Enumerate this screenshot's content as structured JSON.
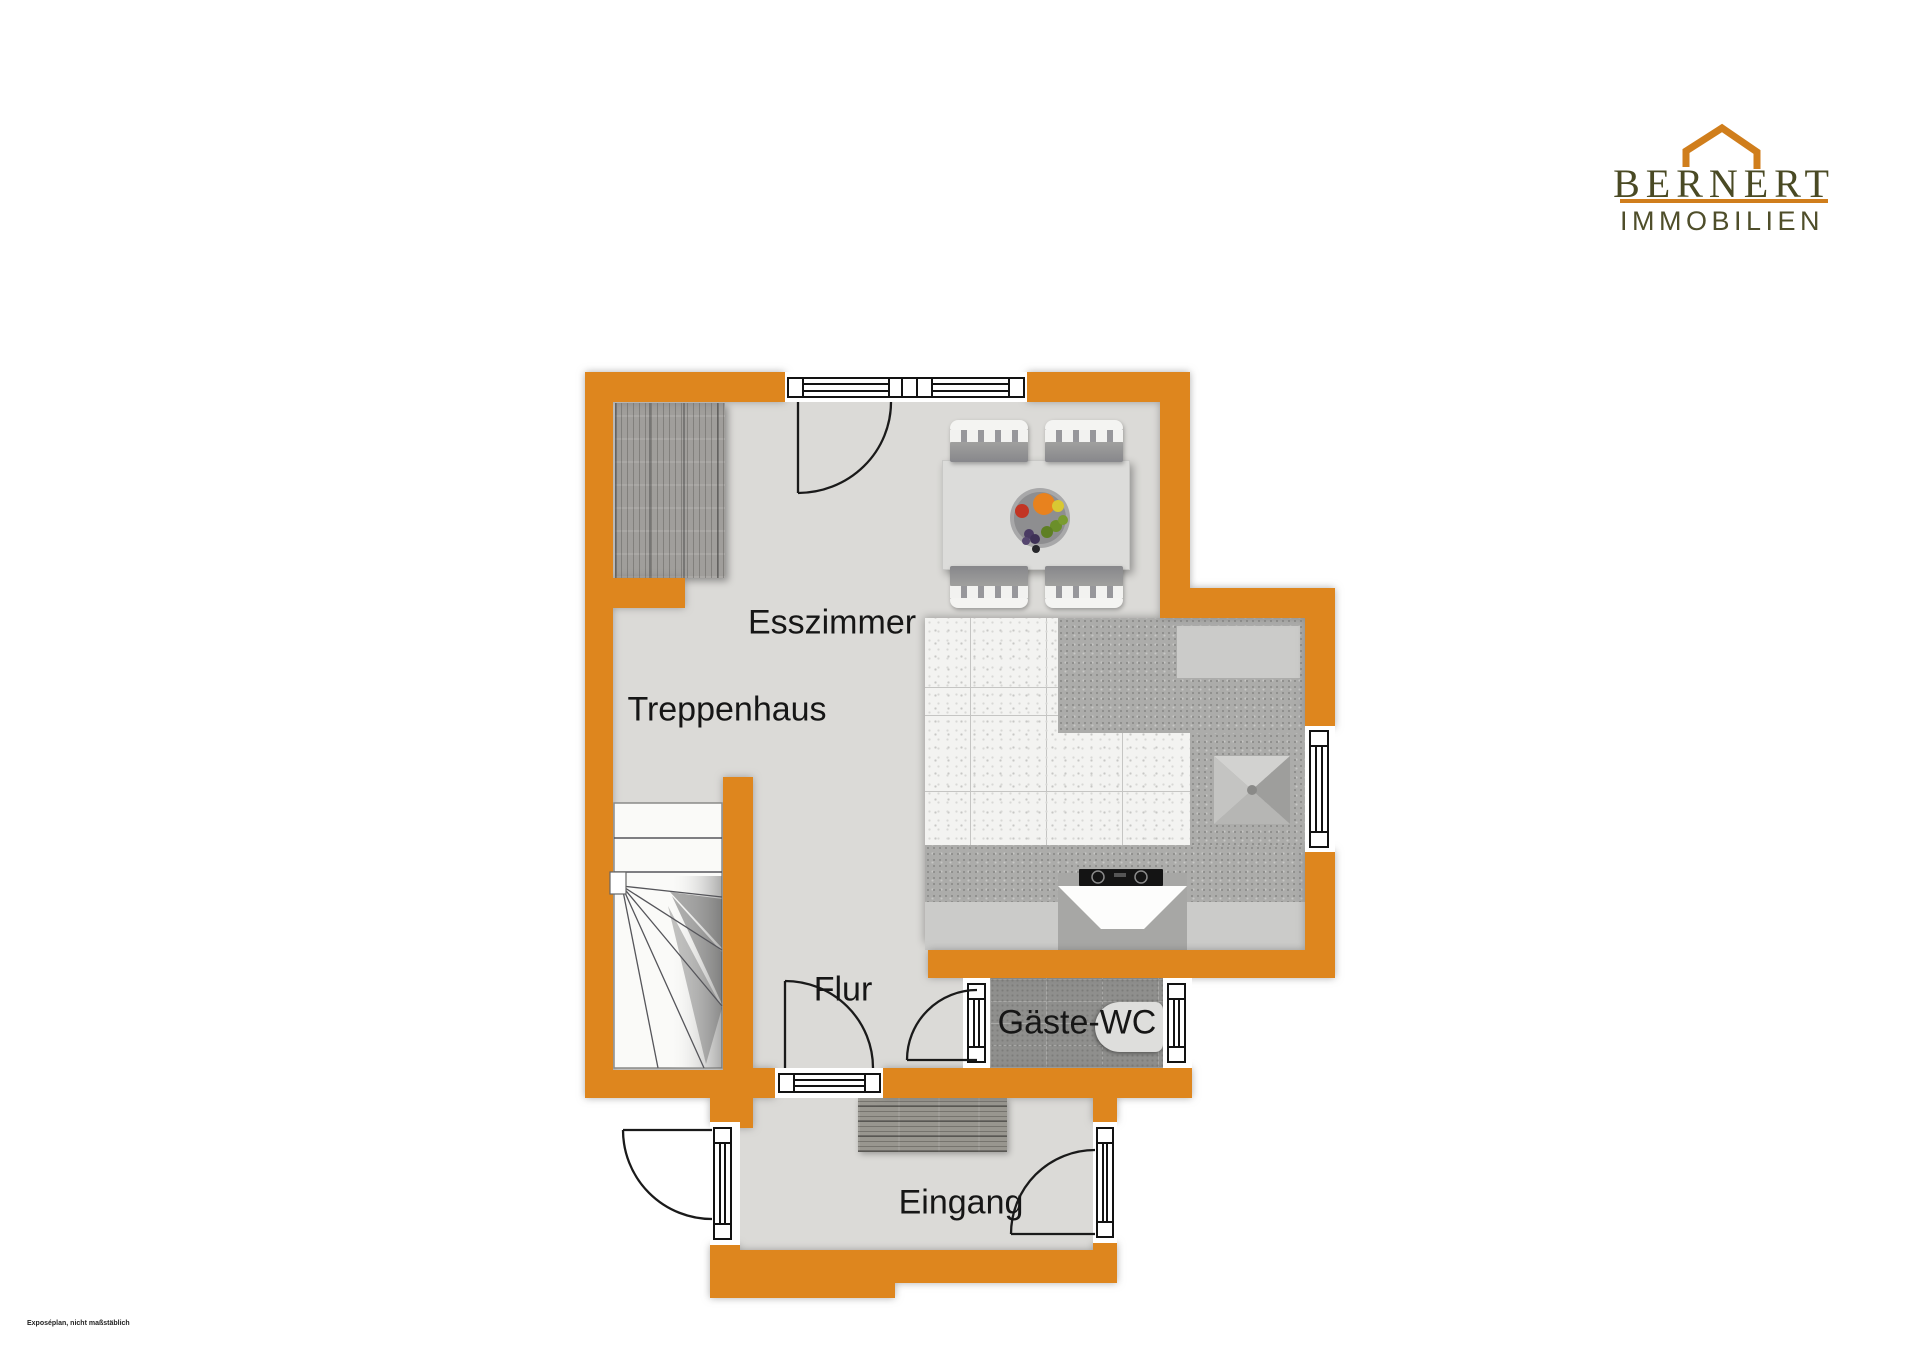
{
  "colors": {
    "wall": "#DE861E",
    "floor": "#DBDAD7",
    "accent": "#D07E1C",
    "brand": "#4A4A24"
  },
  "logo": {
    "roof_icon": "roof-icon",
    "brand": "BERNERT",
    "tagline": "IMMOBILIEN"
  },
  "plan": {
    "rooms": {
      "esszimmer": "Esszimmer",
      "treppenhaus": "Treppenhaus",
      "flur": "Flur",
      "gaeste_wc": "Gäste-WC",
      "eingang": "Eingang"
    }
  },
  "footer": {
    "disclaimer": "Exposéplan, nicht maßstäblich"
  }
}
